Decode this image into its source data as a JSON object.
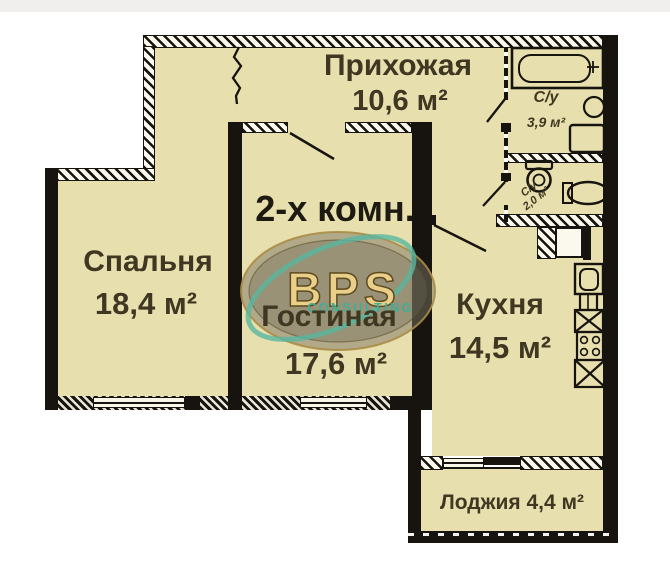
{
  "plan": {
    "type_label": "2-х комн.",
    "rooms": {
      "hallway": {
        "name": "Прихожая",
        "area": "10,6 м²"
      },
      "bathroom_main": {
        "name": "С/у",
        "area": "3,9 м²"
      },
      "bathroom_small": {
        "name": "С/у",
        "area": "2,0 м²"
      },
      "bedroom": {
        "name": "Спальня",
        "area": "18,4 м²"
      },
      "living": {
        "name": "Гостиная",
        "area": "17,6 м²"
      },
      "kitchen": {
        "name": "Кухня",
        "area": "14,5 м²"
      },
      "loggia": {
        "name": "Лоджия 4,4 м²"
      }
    },
    "watermark": {
      "brand": "BPS",
      "subtitle": "CONSULTING"
    },
    "colors": {
      "floor": "#e8dfae",
      "wall": "#17140f",
      "label_text": "#3f3722",
      "brand_gold": "#e9cf8a",
      "brand_teal": "#3fae98"
    }
  }
}
